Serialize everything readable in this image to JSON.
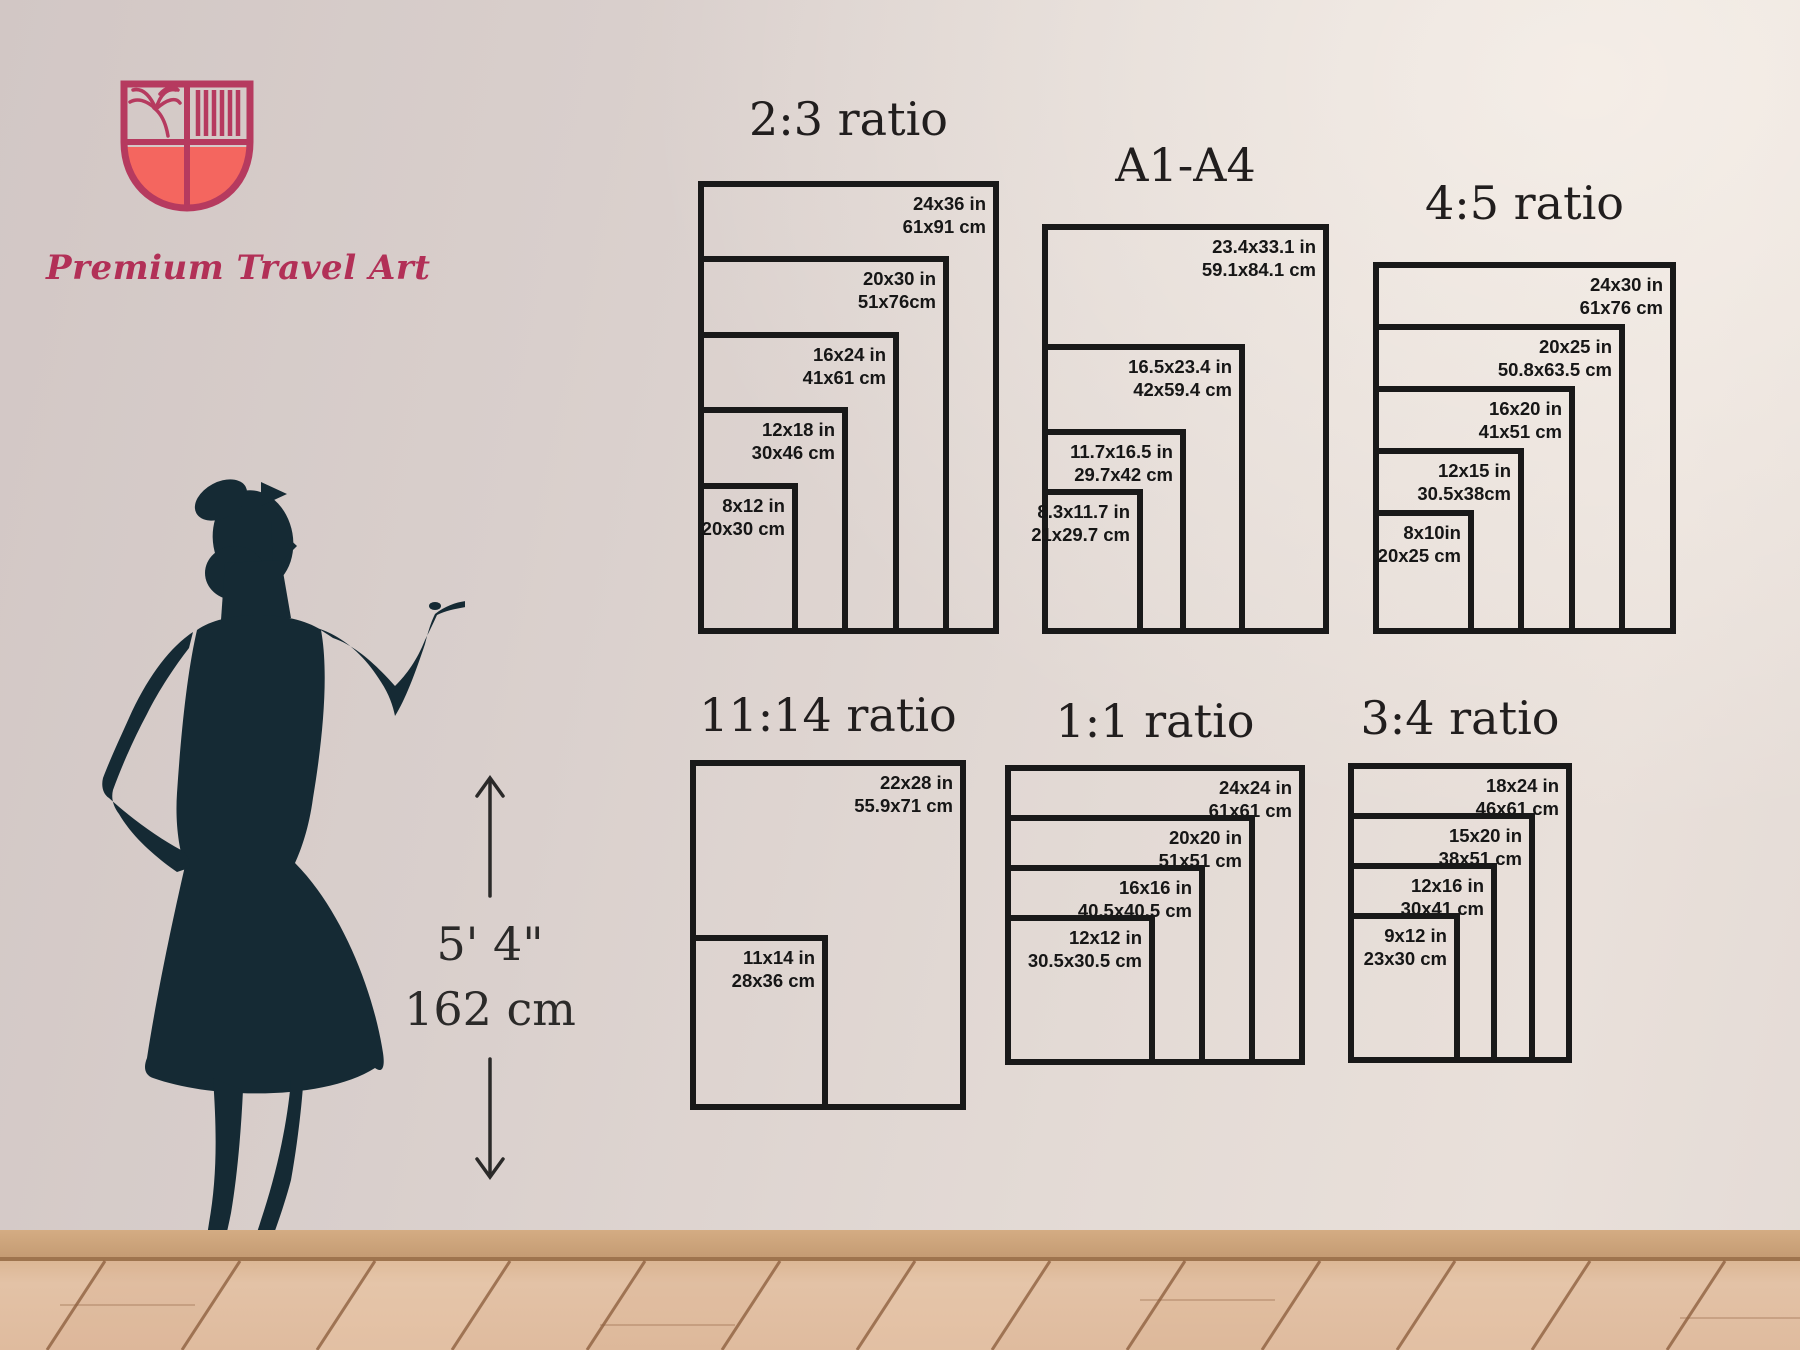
{
  "brand": {
    "name": "Premium Travel Art"
  },
  "height_marker": {
    "feet": "5' 4\"",
    "cm": "162 cm"
  },
  "colors": {
    "frame": "#191919",
    "brand_pink": "#b23057",
    "logo_coral": "#f4665f",
    "silhouette": "#152a34",
    "wall": "#ded4d0",
    "floor_plank": "#e0bda2",
    "floor_seam": "#8f6140"
  },
  "charts": [
    {
      "id": "ratio-2-3",
      "title": "2:3 ratio",
      "sizes": [
        {
          "in": "24x36 in",
          "cm": "61x91 cm"
        },
        {
          "in": "20x30 in",
          "cm": "51x76cm"
        },
        {
          "in": "16x24 in",
          "cm": "41x61 cm"
        },
        {
          "in": "12x18 in",
          "cm": "30x46 cm"
        },
        {
          "in": "8x12 in",
          "cm": "20x30 cm"
        }
      ]
    },
    {
      "id": "a-series",
      "title": "A1-A4",
      "sizes": [
        {
          "in": "23.4x33.1 in",
          "cm": "59.1x84.1 cm"
        },
        {
          "in": "16.5x23.4 in",
          "cm": "42x59.4 cm"
        },
        {
          "in": "11.7x16.5 in",
          "cm": "29.7x42 cm"
        },
        {
          "in": "8.3x11.7 in",
          "cm": "21x29.7 cm"
        }
      ]
    },
    {
      "id": "ratio-4-5",
      "title": "4:5 ratio",
      "sizes": [
        {
          "in": "24x30 in",
          "cm": "61x76 cm"
        },
        {
          "in": "20x25 in",
          "cm": "50.8x63.5 cm"
        },
        {
          "in": "16x20 in",
          "cm": "41x51 cm"
        },
        {
          "in": "12x15 in",
          "cm": "30.5x38cm"
        },
        {
          "in": "8x10in",
          "cm": "20x25 cm"
        }
      ]
    },
    {
      "id": "ratio-11-14",
      "title": "11:14 ratio",
      "sizes": [
        {
          "in": "22x28 in",
          "cm": "55.9x71 cm"
        },
        {
          "in": "11x14 in",
          "cm": "28x36 cm"
        }
      ]
    },
    {
      "id": "ratio-1-1",
      "title": "1:1 ratio",
      "sizes": [
        {
          "in": "24x24 in",
          "cm": "61x61 cm"
        },
        {
          "in": "20x20 in",
          "cm": "51x51 cm"
        },
        {
          "in": "16x16 in",
          "cm": "40.5x40.5 cm"
        },
        {
          "in": "12x12 in",
          "cm": "30.5x30.5 cm"
        }
      ]
    },
    {
      "id": "ratio-3-4",
      "title": "3:4 ratio",
      "sizes": [
        {
          "in": "18x24 in",
          "cm": "46x61 cm"
        },
        {
          "in": "15x20 in",
          "cm": "38x51 cm"
        },
        {
          "in": "12x16 in",
          "cm": "30x41 cm"
        },
        {
          "in": "9x12 in",
          "cm": "23x30 cm"
        }
      ]
    }
  ]
}
